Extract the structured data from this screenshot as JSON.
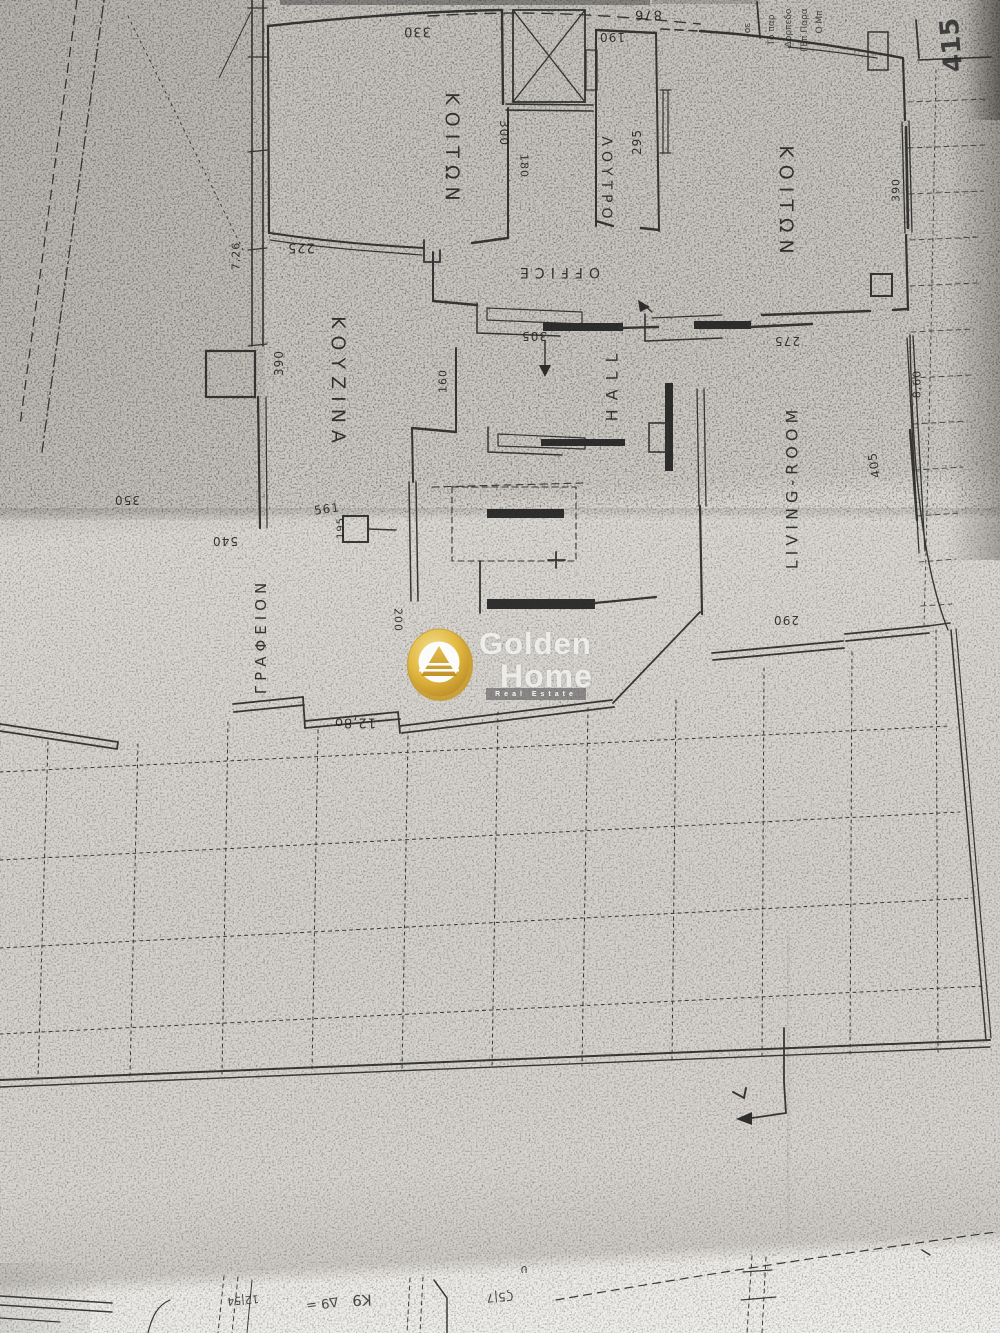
{
  "logo": {
    "line1": "Golden",
    "line2": "Home",
    "tagline": "Real Estate",
    "coin_gold": "#e3b83a",
    "coin_gold_dark": "#c08f1d",
    "coin_inner": "#ffffff"
  },
  "plan": {
    "room_labels": [
      {
        "name": "room-label-bedroom-left",
        "text": "ΚΟΙΤΩΝ",
        "x": 452,
        "y": 150,
        "rot": 90,
        "size": 19,
        "ls": 7
      },
      {
        "name": "room-label-bathroom",
        "text": "ΛΟΥΤΡΟ",
        "x": 606,
        "y": 180,
        "rot": 90,
        "size": 14,
        "ls": 5
      },
      {
        "name": "room-label-office",
        "text": "OFFICE",
        "x": 557,
        "y": 272,
        "rot": 180,
        "size": 14,
        "ls": 6
      },
      {
        "name": "room-label-kitchen",
        "text": "ΚΟΥΖΙΝΑ",
        "x": 338,
        "y": 383,
        "rot": 90,
        "size": 19,
        "ls": 7
      },
      {
        "name": "room-label-hall",
        "text": "HALL",
        "x": 612,
        "y": 383,
        "rot": -90,
        "size": 16,
        "ls": 9
      },
      {
        "name": "room-label-bedroom-right",
        "text": "ΚΟΙΤΩΝ",
        "x": 786,
        "y": 203,
        "rot": 90,
        "size": 19,
        "ls": 7
      },
      {
        "name": "room-label-living-room",
        "text": "LIVING-ROOM",
        "x": 792,
        "y": 487,
        "rot": -90,
        "size": 16,
        "ls": 5
      },
      {
        "name": "room-label-study",
        "text": "ΓΡΑΦΕΙΟΝ",
        "x": 261,
        "y": 636,
        "rot": -90,
        "size": 15,
        "ls": 5
      }
    ],
    "dimension_labels": [
      {
        "text": "876",
        "x": 648,
        "y": 14,
        "rot": 180,
        "size": 13
      },
      {
        "text": "330",
        "x": 417,
        "y": 31,
        "rot": 180,
        "size": 13
      },
      {
        "text": "190",
        "x": 612,
        "y": 37,
        "rot": 180,
        "size": 12
      },
      {
        "text": "300",
        "x": 504,
        "y": 133,
        "rot": 90,
        "size": 12
      },
      {
        "text": "180",
        "x": 524,
        "y": 166,
        "rot": 90,
        "size": 11
      },
      {
        "text": "295",
        "x": 637,
        "y": 142,
        "rot": -90,
        "size": 12
      },
      {
        "text": "225",
        "x": 301,
        "y": 247,
        "rot": 180,
        "size": 13
      },
      {
        "text": "7,26",
        "x": 236,
        "y": 256,
        "rot": -90,
        "size": 11
      },
      {
        "text": "390",
        "x": 279,
        "y": 363,
        "rot": -90,
        "size": 12
      },
      {
        "text": "160",
        "x": 443,
        "y": 381,
        "rot": -90,
        "size": 11
      },
      {
        "text": "305",
        "x": 534,
        "y": 336,
        "rot": 180,
        "size": 12
      },
      {
        "text": "275",
        "x": 787,
        "y": 341,
        "rot": 180,
        "size": 12
      },
      {
        "text": "390",
        "x": 896,
        "y": 190,
        "rot": -90,
        "size": 11
      },
      {
        "text": "8,60",
        "x": 917,
        "y": 384,
        "rot": -90,
        "size": 11
      },
      {
        "text": "405",
        "x": 874,
        "y": 465,
        "rot": -100,
        "size": 12
      },
      {
        "text": "290",
        "x": 786,
        "y": 620,
        "rot": 180,
        "size": 12
      },
      {
        "text": "200",
        "x": 398,
        "y": 620,
        "rot": 90,
        "size": 11
      },
      {
        "text": "561",
        "x": 327,
        "y": 509,
        "rot": -8,
        "size": 12
      },
      {
        "text": "195",
        "x": 341,
        "y": 528,
        "rot": -90,
        "size": 10
      },
      {
        "text": "350",
        "x": 127,
        "y": 500,
        "rot": 180,
        "size": 12
      },
      {
        "text": "540",
        "x": 225,
        "y": 541,
        "rot": 180,
        "size": 12
      },
      {
        "text": "12,8o",
        "x": 355,
        "y": 722,
        "rot": 180,
        "size": 13
      }
    ],
    "handwritten_notes": [
      {
        "name": "note-415",
        "text": "415",
        "x": 952,
        "y": 45,
        "rot": -95,
        "size": 26,
        "weight": 600
      },
      {
        "name": "note-top-1",
        "text": "Τό παρ",
        "x": 772,
        "y": 30,
        "rot": -90,
        "size": 9
      },
      {
        "name": "note-top-2",
        "text": "Δορπεδο",
        "x": 789,
        "y": 28,
        "rot": -90,
        "size": 9
      },
      {
        "name": "note-top-3",
        "text": "ΓΕπ Παρα",
        "x": 805,
        "y": 30,
        "rot": -90,
        "size": 9
      },
      {
        "name": "note-top-4",
        "text": "Ο Μπ",
        "x": 820,
        "y": 22,
        "rot": -90,
        "size": 9
      },
      {
        "name": "note-top-5",
        "text": "οε",
        "x": 748,
        "y": 28,
        "rot": -90,
        "size": 9
      },
      {
        "name": "note-bottom-1",
        "text": "Δ9 =",
        "x": 322,
        "y": 1303,
        "rot": 172,
        "size": 13
      },
      {
        "name": "note-bottom-2",
        "text": "Κ9",
        "x": 362,
        "y": 1300,
        "rot": 178,
        "size": 15
      },
      {
        "name": "note-bottom-3",
        "text": "12|54",
        "x": 243,
        "y": 1300,
        "rot": 175,
        "size": 11
      },
      {
        "name": "note-bottom-4",
        "text": "Ϛ5|7",
        "x": 500,
        "y": 1297,
        "rot": 175,
        "size": 12
      },
      {
        "name": "note-bottom-5",
        "text": "υ",
        "x": 524,
        "y": 1270,
        "rot": 180,
        "size": 12
      }
    ]
  }
}
